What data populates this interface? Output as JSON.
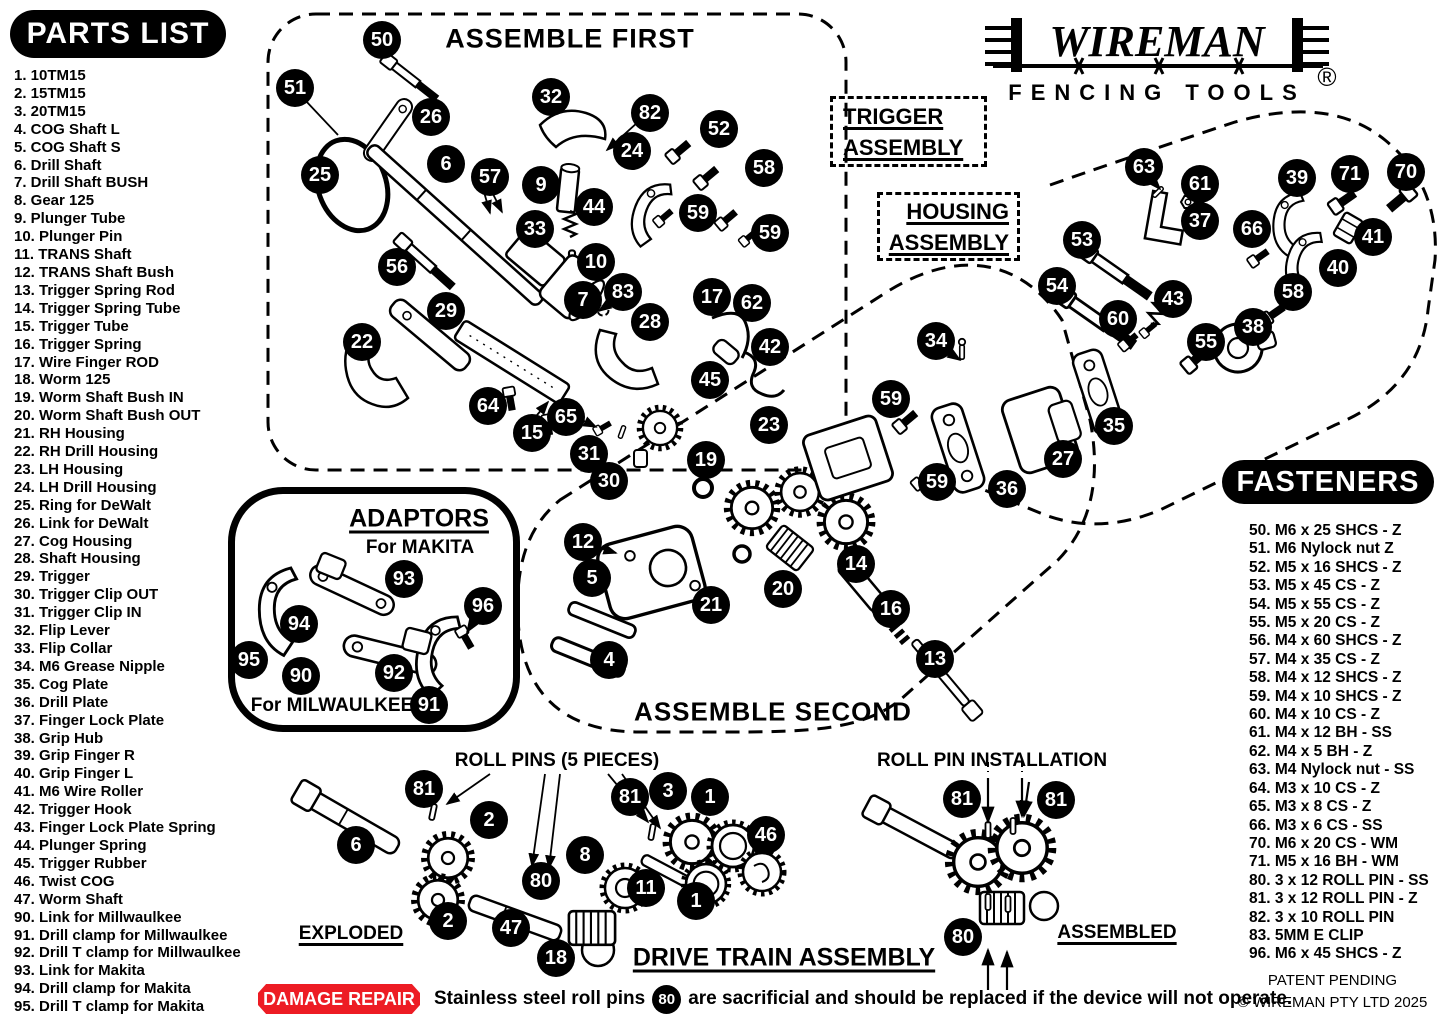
{
  "colors": {
    "ink": "#000000",
    "paper": "#ffffff",
    "accent_red": "#ed1c24"
  },
  "logo": {
    "brand": "WIREMAN",
    "registered": "®",
    "tagline": "FENCING TOOLS"
  },
  "headers": {
    "parts_list": "PARTS LIST",
    "fasteners": "FASTENERS"
  },
  "sections": {
    "assemble_first": "ASSEMBLE FIRST",
    "trigger_line1": "TRIGGER",
    "trigger_line2": "ASSEMBLY",
    "housing_line1": "HOUSING",
    "housing_line2": "ASSEMBLY",
    "assemble_second": "ASSEMBLE SECOND",
    "adaptors_title": "ADAPTORS",
    "adaptors_makita": "For MAKITA",
    "adaptors_milwaukee": "For MILWAULKEE",
    "roll_pins": "ROLL PINS (5 PIECES)",
    "roll_pin_installation": "ROLL PIN INSTALLATION",
    "exploded": "EXPLODED",
    "assembled": "ASSEMBLED",
    "drive_train": "DRIVE TRAIN ASSEMBLY"
  },
  "footer": {
    "damage_repair_label": "DAMAGE REPAIR",
    "damage_note_pre": "Stainless steel roll pins",
    "damage_note_balloon": "80",
    "damage_note_post": "are sacrificial and should be replaced if the device will not operate.",
    "patent": "PATENT PENDING",
    "copyright": "© WIREMAN PTY LTD 2025"
  },
  "parts_list": [
    {
      "n": "1",
      "text": "10TM15"
    },
    {
      "n": "2",
      "text": "15TM15"
    },
    {
      "n": "3",
      "text": "20TM15"
    },
    {
      "n": "4",
      "text": "COG Shaft L"
    },
    {
      "n": "5",
      "text": "COG Shaft S"
    },
    {
      "n": "6",
      "text": "Drill Shaft"
    },
    {
      "n": "7",
      "text": "Drill Shaft BUSH"
    },
    {
      "n": "8",
      "text": "Gear 125"
    },
    {
      "n": "9",
      "text": "Plunger Tube"
    },
    {
      "n": "10",
      "text": "Plunger Pin"
    },
    {
      "n": "11",
      "text": "TRANS Shaft"
    },
    {
      "n": "12",
      "text": "TRANS Shaft Bush"
    },
    {
      "n": "13",
      "text": "Trigger Spring Rod"
    },
    {
      "n": "14",
      "text": "Trigger Spring Tube"
    },
    {
      "n": "15",
      "text": "Trigger Tube"
    },
    {
      "n": "16",
      "text": "Trigger Spring"
    },
    {
      "n": "17",
      "text": "Wire Finger ROD"
    },
    {
      "n": "18",
      "text": "Worm 125"
    },
    {
      "n": "19",
      "text": "Worm Shaft Bush IN"
    },
    {
      "n": "20",
      "text": "Worm Shaft Bush OUT"
    },
    {
      "n": "21",
      "text": "RH Housing"
    },
    {
      "n": "22",
      "text": "RH Drill Housing"
    },
    {
      "n": "23",
      "text": "LH Housing"
    },
    {
      "n": "24",
      "text": "LH Drill Housing"
    },
    {
      "n": "25",
      "text": "Ring for DeWalt"
    },
    {
      "n": "26",
      "text": "Link for DeWalt"
    },
    {
      "n": "27",
      "text": "Cog Housing"
    },
    {
      "n": "28",
      "text": "Shaft Housing"
    },
    {
      "n": "29",
      "text": "Trigger"
    },
    {
      "n": "30",
      "text": "Trigger Clip OUT"
    },
    {
      "n": "31",
      "text": "Trigger Clip IN"
    },
    {
      "n": "32",
      "text": "Flip Lever"
    },
    {
      "n": "33",
      "text": "Flip Collar"
    },
    {
      "n": "34",
      "text": "M6 Grease Nipple"
    },
    {
      "n": "35",
      "text": "Cog Plate"
    },
    {
      "n": "36",
      "text": "Drill Plate"
    },
    {
      "n": "37",
      "text": "Finger Lock Plate"
    },
    {
      "n": "38",
      "text": "Grip Hub"
    },
    {
      "n": "39",
      "text": "Grip Finger R"
    },
    {
      "n": "40",
      "text": "Grip Finger L"
    },
    {
      "n": "41",
      "text": "M6 Wire Roller"
    },
    {
      "n": "42",
      "text": "Trigger Hook"
    },
    {
      "n": "43",
      "text": "Finger Lock Plate Spring"
    },
    {
      "n": "44",
      "text": "Plunger Spring"
    },
    {
      "n": "45",
      "text": "Trigger Rubber"
    },
    {
      "n": "46",
      "text": "Twist COG"
    },
    {
      "n": "47",
      "text": "Worm Shaft"
    },
    {
      "n": "90",
      "text": "Link for Millwaulkee"
    },
    {
      "n": "91",
      "text": "Drill clamp for Millwaulkee"
    },
    {
      "n": "92",
      "text": "Drill T clamp for Millwaulkee"
    },
    {
      "n": "93",
      "text": "Link for Makita"
    },
    {
      "n": "94",
      "text": "Drill clamp for Makita"
    },
    {
      "n": "95",
      "text": "Drill T clamp for Makita"
    }
  ],
  "fasteners": [
    {
      "n": "50",
      "text": "M6 x 25 SHCS - Z"
    },
    {
      "n": "51",
      "text": "M6 Nylock nut Z"
    },
    {
      "n": "52",
      "text": "M5 x 16 SHCS - Z"
    },
    {
      "n": "53",
      "text": "M5 x 45 CS - Z"
    },
    {
      "n": "54",
      "text": "M5 x 55 CS - Z"
    },
    {
      "n": "55",
      "text": "M5 x 20 CS - Z"
    },
    {
      "n": "56",
      "text": "M4 x 60 SHCS - Z"
    },
    {
      "n": "57",
      "text": "M4 x 35 CS - Z"
    },
    {
      "n": "58",
      "text": "M4 x 12 SHCS - Z"
    },
    {
      "n": "59",
      "text": "M4 x 10 SHCS - Z"
    },
    {
      "n": "60",
      "text": "M4 x 10 CS - Z"
    },
    {
      "n": "61",
      "text": "M4 x 12 BH - SS"
    },
    {
      "n": "62",
      "text": "M4 x 5 BH - Z"
    },
    {
      "n": "63",
      "text": "M4 Nylock nut - SS"
    },
    {
      "n": "64",
      "text": "M3 x 10 CS - Z"
    },
    {
      "n": "65",
      "text": "M3 x 8 CS - Z"
    },
    {
      "n": "66",
      "text": "M3 x 6 CS - SS"
    },
    {
      "n": "70",
      "text": "M6 x 20 CS - WM"
    },
    {
      "n": "71",
      "text": "M5 x 16 BH - WM"
    },
    {
      "n": "80",
      "text": "3 x 12 ROLL PIN - SS"
    },
    {
      "n": "81",
      "text": "3 x 12 ROLL PIN - Z"
    },
    {
      "n": "82",
      "text": "3 x 10 ROLL PIN"
    },
    {
      "n": "83",
      "text": "5MM E CLIP"
    },
    {
      "n": "96",
      "text": "M6 x 45 SHCS - Z"
    }
  ],
  "balloons": [
    {
      "n": "50",
      "x": 382,
      "y": 40
    },
    {
      "n": "51",
      "x": 295,
      "y": 88
    },
    {
      "n": "26",
      "x": 431,
      "y": 117
    },
    {
      "n": "25",
      "x": 320,
      "y": 175
    },
    {
      "n": "6",
      "x": 446,
      "y": 164
    },
    {
      "n": "57",
      "x": 490,
      "y": 177
    },
    {
      "n": "32",
      "x": 551,
      "y": 97
    },
    {
      "n": "82",
      "x": 650,
      "y": 113
    },
    {
      "n": "24",
      "x": 632,
      "y": 151
    },
    {
      "n": "52",
      "x": 719,
      "y": 129
    },
    {
      "n": "58",
      "x": 764,
      "y": 168
    },
    {
      "n": "9",
      "x": 541,
      "y": 185
    },
    {
      "n": "44",
      "x": 594,
      "y": 207
    },
    {
      "n": "33",
      "x": 535,
      "y": 229
    },
    {
      "n": "59",
      "x": 698,
      "y": 213
    },
    {
      "n": "59",
      "x": 770,
      "y": 233
    },
    {
      "n": "56",
      "x": 397,
      "y": 267
    },
    {
      "n": "10",
      "x": 596,
      "y": 262
    },
    {
      "n": "7",
      "x": 583,
      "y": 300
    },
    {
      "n": "83",
      "x": 623,
      "y": 292
    },
    {
      "n": "29",
      "x": 446,
      "y": 311
    },
    {
      "n": "17",
      "x": 712,
      "y": 297
    },
    {
      "n": "62",
      "x": 752,
      "y": 303
    },
    {
      "n": "28",
      "x": 650,
      "y": 322
    },
    {
      "n": "22",
      "x": 362,
      "y": 342
    },
    {
      "n": "42",
      "x": 770,
      "y": 347
    },
    {
      "n": "45",
      "x": 710,
      "y": 380
    },
    {
      "n": "64",
      "x": 488,
      "y": 406
    },
    {
      "n": "65",
      "x": 566,
      "y": 417
    },
    {
      "n": "15",
      "x": 532,
      "y": 433
    },
    {
      "n": "31",
      "x": 589,
      "y": 454
    },
    {
      "n": "30",
      "x": 609,
      "y": 481
    },
    {
      "n": "19",
      "x": 706,
      "y": 460
    },
    {
      "n": "23",
      "x": 769,
      "y": 425
    },
    {
      "n": "12",
      "x": 583,
      "y": 542
    },
    {
      "n": "5",
      "x": 592,
      "y": 578
    },
    {
      "n": "21",
      "x": 711,
      "y": 605
    },
    {
      "n": "20",
      "x": 783,
      "y": 589
    },
    {
      "n": "14",
      "x": 856,
      "y": 564
    },
    {
      "n": "16",
      "x": 891,
      "y": 609
    },
    {
      "n": "4",
      "x": 609,
      "y": 660
    },
    {
      "n": "13",
      "x": 935,
      "y": 659
    },
    {
      "n": "59",
      "x": 891,
      "y": 399
    },
    {
      "n": "34",
      "x": 936,
      "y": 341
    },
    {
      "n": "59",
      "x": 937,
      "y": 482
    },
    {
      "n": "36",
      "x": 1007,
      "y": 489
    },
    {
      "n": "27",
      "x": 1063,
      "y": 459
    },
    {
      "n": "35",
      "x": 1114,
      "y": 426
    },
    {
      "n": "63",
      "x": 1144,
      "y": 167
    },
    {
      "n": "61",
      "x": 1200,
      "y": 184
    },
    {
      "n": "37",
      "x": 1200,
      "y": 221
    },
    {
      "n": "39",
      "x": 1297,
      "y": 178
    },
    {
      "n": "71",
      "x": 1350,
      "y": 174
    },
    {
      "n": "70",
      "x": 1406,
      "y": 172
    },
    {
      "n": "66",
      "x": 1252,
      "y": 229
    },
    {
      "n": "41",
      "x": 1373,
      "y": 237
    },
    {
      "n": "40",
      "x": 1338,
      "y": 268
    },
    {
      "n": "53",
      "x": 1082,
      "y": 240
    },
    {
      "n": "54",
      "x": 1057,
      "y": 286
    },
    {
      "n": "60",
      "x": 1118,
      "y": 319
    },
    {
      "n": "43",
      "x": 1173,
      "y": 299
    },
    {
      "n": "55",
      "x": 1206,
      "y": 342
    },
    {
      "n": "58",
      "x": 1293,
      "y": 292
    },
    {
      "n": "38",
      "x": 1253,
      "y": 327
    },
    {
      "n": "93",
      "x": 404,
      "y": 579
    },
    {
      "n": "96",
      "x": 483,
      "y": 606
    },
    {
      "n": "94",
      "x": 299,
      "y": 624
    },
    {
      "n": "95",
      "x": 249,
      "y": 660
    },
    {
      "n": "90",
      "x": 301,
      "y": 676
    },
    {
      "n": "92",
      "x": 394,
      "y": 673
    },
    {
      "n": "91",
      "x": 429,
      "y": 705
    },
    {
      "n": "81",
      "x": 424,
      "y": 789
    },
    {
      "n": "2",
      "x": 489,
      "y": 820
    },
    {
      "n": "6",
      "x": 356,
      "y": 845
    },
    {
      "n": "81",
      "x": 630,
      "y": 797
    },
    {
      "n": "3",
      "x": 668,
      "y": 791
    },
    {
      "n": "1",
      "x": 710,
      "y": 797
    },
    {
      "n": "46",
      "x": 766,
      "y": 835
    },
    {
      "n": "8",
      "x": 585,
      "y": 855
    },
    {
      "n": "80",
      "x": 541,
      "y": 881
    },
    {
      "n": "11",
      "x": 646,
      "y": 888
    },
    {
      "n": "1",
      "x": 696,
      "y": 901
    },
    {
      "n": "2",
      "x": 448,
      "y": 921
    },
    {
      "n": "47",
      "x": 511,
      "y": 928
    },
    {
      "n": "18",
      "x": 556,
      "y": 958
    },
    {
      "n": "81",
      "x": 962,
      "y": 799
    },
    {
      "n": "81",
      "x": 1056,
      "y": 800
    },
    {
      "n": "80",
      "x": 963,
      "y": 937
    }
  ]
}
